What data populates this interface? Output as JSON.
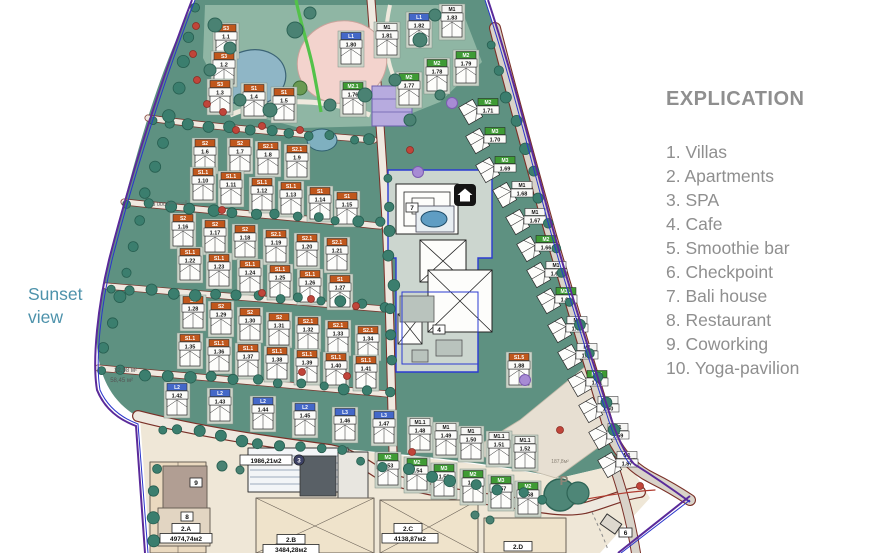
{
  "legend": {
    "title": "EXPLICATION",
    "items": [
      "1. Villas",
      "2. Apartments",
      "3. SPA",
      "4. Cafe",
      "5. Smoothie bar",
      "6. Checkpoint",
      "7. Bali house",
      "8. Restaurant",
      "9. Coworking",
      "10. Yoga-pavilion"
    ]
  },
  "sunset": {
    "line1": "Sunset",
    "line2": "view"
  },
  "map": {
    "colors": {
      "land": "#5e9181",
      "park": "#8fb6a4",
      "beige": "#efe7d7",
      "road": "#efe9e0",
      "road_edge": "#7a3028",
      "boundary_purple": "#5a2a9a",
      "boundary_blue": "#2a35cc",
      "zone": "#ccd6cf",
      "zone_outline": "#2b3bd2",
      "pond": "#8fb6c6",
      "pink": "#f3d3cd",
      "chip_orange": "#c0571c",
      "chip_green": "#3f9b35",
      "chip_blue": "#4468c8",
      "hedge": "#3b7e6e",
      "tree_red": "#c0453a",
      "tree_purple": "#a78bd4"
    },
    "annotations": {
      "dim_3000": "3 000",
      "area_small_1": "32,98 м²",
      "area_small_2": "58,45 м²",
      "parking_area": "187,8м²",
      "parking": "P",
      "spa_area": "1986,21м2",
      "spa_num": "3",
      "b2a": "2.A",
      "b2a_area": "4974,74м2",
      "b2b": "2.B",
      "b2b_area": "3484,28м2",
      "b2c": "2.C",
      "b2c_area": "4138,87м2",
      "b2d": "2.D",
      "coworking_num": "9",
      "restaurant_num": "8",
      "checkpoint_num": "6",
      "cafe_num": "4",
      "bali_num": "7"
    },
    "units": [
      {
        "c": "S3",
        "n": "1.1",
        "x": 226,
        "y": 28,
        "t": "o"
      },
      {
        "c": "S3",
        "n": "1.2",
        "x": 224,
        "y": 56,
        "t": "o"
      },
      {
        "c": "S3",
        "n": "1.3",
        "x": 220,
        "y": 84,
        "t": "o"
      },
      {
        "c": "S1",
        "n": "1.4",
        "x": 254,
        "y": 88,
        "t": "o"
      },
      {
        "c": "S1",
        "n": "1.5",
        "x": 284,
        "y": 92,
        "t": "o"
      },
      {
        "c": "S2",
        "n": "1.6",
        "x": 205,
        "y": 143,
        "t": "o"
      },
      {
        "c": "S2",
        "n": "1.7",
        "x": 240,
        "y": 143,
        "t": "o"
      },
      {
        "c": "S2.1",
        "n": "1.8",
        "x": 268,
        "y": 146,
        "t": "o"
      },
      {
        "c": "S2.1",
        "n": "1.9",
        "x": 297,
        "y": 149,
        "t": "o"
      },
      {
        "c": "S1.1",
        "n": "1.10",
        "x": 203,
        "y": 172,
        "t": "o"
      },
      {
        "c": "S1.1",
        "n": "1.11",
        "x": 231,
        "y": 176,
        "t": "o"
      },
      {
        "c": "S1.1",
        "n": "1.12",
        "x": 262,
        "y": 182,
        "t": "o"
      },
      {
        "c": "S1.1",
        "n": "1.13",
        "x": 291,
        "y": 186,
        "t": "o"
      },
      {
        "c": "S1",
        "n": "1.14",
        "x": 320,
        "y": 191,
        "t": "o"
      },
      {
        "c": "S1",
        "n": "1.15",
        "x": 347,
        "y": 196,
        "t": "o"
      },
      {
        "c": "S2",
        "n": "1.16",
        "x": 183,
        "y": 218,
        "t": "o"
      },
      {
        "c": "S2",
        "n": "1.17",
        "x": 215,
        "y": 224,
        "t": "o"
      },
      {
        "c": "S2",
        "n": "1.18",
        "x": 245,
        "y": 229,
        "t": "o"
      },
      {
        "c": "S2.1",
        "n": "1.19",
        "x": 276,
        "y": 234,
        "t": "o"
      },
      {
        "c": "S2.1",
        "n": "1.20",
        "x": 307,
        "y": 238,
        "t": "o"
      },
      {
        "c": "S2.1",
        "n": "1.21",
        "x": 337,
        "y": 242,
        "t": "o"
      },
      {
        "c": "S1.1",
        "n": "1.22",
        "x": 190,
        "y": 252,
        "t": "o"
      },
      {
        "c": "S1.1",
        "n": "1.23",
        "x": 219,
        "y": 258,
        "t": "o"
      },
      {
        "c": "S1.1",
        "n": "1.24",
        "x": 250,
        "y": 264,
        "t": "o"
      },
      {
        "c": "S1.1",
        "n": "1.25",
        "x": 280,
        "y": 269,
        "t": "o"
      },
      {
        "c": "S1.1",
        "n": "1.26",
        "x": 310,
        "y": 274,
        "t": "o"
      },
      {
        "c": "S1",
        "n": "1.27",
        "x": 340,
        "y": 279,
        "t": "o"
      },
      {
        "c": "S2",
        "n": "1.28",
        "x": 193,
        "y": 300,
        "t": "o"
      },
      {
        "c": "S2",
        "n": "1.29",
        "x": 221,
        "y": 306,
        "t": "o"
      },
      {
        "c": "S2",
        "n": "1.30",
        "x": 250,
        "y": 312,
        "t": "o"
      },
      {
        "c": "S2",
        "n": "1.31",
        "x": 279,
        "y": 317,
        "t": "o"
      },
      {
        "c": "S2.1",
        "n": "1.32",
        "x": 308,
        "y": 321,
        "t": "o"
      },
      {
        "c": "S2.1",
        "n": "1.33",
        "x": 338,
        "y": 325,
        "t": "o"
      },
      {
        "c": "S2.1",
        "n": "1.34",
        "x": 368,
        "y": 330,
        "t": "o"
      },
      {
        "c": "S1.1",
        "n": "1.35",
        "x": 190,
        "y": 338,
        "t": "o"
      },
      {
        "c": "S1.1",
        "n": "1.36",
        "x": 219,
        "y": 343,
        "t": "o"
      },
      {
        "c": "S1.1",
        "n": "1.37",
        "x": 248,
        "y": 348,
        "t": "o"
      },
      {
        "c": "S1.1",
        "n": "1.38",
        "x": 277,
        "y": 351,
        "t": "o"
      },
      {
        "c": "S1.1",
        "n": "1.39",
        "x": 307,
        "y": 354,
        "t": "o"
      },
      {
        "c": "S1.1",
        "n": "1.40",
        "x": 336,
        "y": 357,
        "t": "o"
      },
      {
        "c": "S1.1",
        "n": "1.41",
        "x": 366,
        "y": 360,
        "t": "o"
      },
      {
        "c": "L2",
        "n": "1.42",
        "x": 177,
        "y": 387,
        "t": "b"
      },
      {
        "c": "L2",
        "n": "1.43",
        "x": 220,
        "y": 393,
        "t": "b"
      },
      {
        "c": "L2",
        "n": "1.44",
        "x": 263,
        "y": 401,
        "t": "b"
      },
      {
        "c": "L2",
        "n": "1.45",
        "x": 305,
        "y": 407,
        "t": "b"
      },
      {
        "c": "L3",
        "n": "1.46",
        "x": 345,
        "y": 412,
        "t": "b"
      },
      {
        "c": "L3",
        "n": "1.47",
        "x": 384,
        "y": 415,
        "t": "b"
      },
      {
        "c": "M1.1",
        "n": "1.48",
        "x": 420,
        "y": 422,
        "t": "w"
      },
      {
        "c": "M1",
        "n": "1.49",
        "x": 446,
        "y": 427,
        "t": "w"
      },
      {
        "c": "M1",
        "n": "1.50",
        "x": 471,
        "y": 431,
        "t": "w"
      },
      {
        "c": "M1.1",
        "n": "1.51",
        "x": 499,
        "y": 436,
        "t": "w"
      },
      {
        "c": "M1.1",
        "n": "1.52",
        "x": 525,
        "y": 440,
        "t": "w"
      },
      {
        "c": "M2",
        "n": "1.53",
        "x": 388,
        "y": 457,
        "t": "g"
      },
      {
        "c": "M2",
        "n": "1.54",
        "x": 417,
        "y": 462,
        "t": "g"
      },
      {
        "c": "M3",
        "n": "1.55",
        "x": 444,
        "y": 468,
        "t": "g"
      },
      {
        "c": "M2",
        "n": "1.56",
        "x": 473,
        "y": 474,
        "t": "g"
      },
      {
        "c": "M3",
        "n": "1.57",
        "x": 501,
        "y": 480,
        "t": "g"
      },
      {
        "c": "M2",
        "n": "1.58",
        "x": 528,
        "y": 486,
        "t": "g"
      },
      {
        "c": "L1",
        "n": "1.80",
        "x": 351,
        "y": 36,
        "t": "b"
      },
      {
        "c": "M1",
        "n": "1.81",
        "x": 387,
        "y": 27,
        "t": "w"
      },
      {
        "c": "L1",
        "n": "1.82",
        "x": 419,
        "y": 17,
        "t": "b"
      },
      {
        "c": "M1",
        "n": "1.83",
        "x": 452,
        "y": 9,
        "t": "w"
      },
      {
        "c": "M2.1",
        "n": "1.76",
        "x": 353,
        "y": 86,
        "t": "g"
      },
      {
        "c": "M2",
        "n": "1.77",
        "x": 409,
        "y": 77,
        "t": "g"
      },
      {
        "c": "M2",
        "n": "1.78",
        "x": 437,
        "y": 63,
        "t": "g"
      },
      {
        "c": "M2",
        "n": "1.79",
        "x": 466,
        "y": 55,
        "t": "g"
      },
      {
        "c": "M2",
        "n": "1.71",
        "x": 488,
        "y": 102,
        "t": "g",
        "r": 60
      },
      {
        "c": "M3",
        "n": "1.70",
        "x": 495,
        "y": 131,
        "t": "g",
        "r": 60
      },
      {
        "c": "M3",
        "n": "1.69",
        "x": 505,
        "y": 160,
        "t": "g",
        "r": 60
      },
      {
        "c": "M1",
        "n": "1.68",
        "x": 522,
        "y": 185,
        "t": "w",
        "r": 60
      },
      {
        "c": "M1",
        "n": "1.67",
        "x": 535,
        "y": 212,
        "t": "w",
        "r": 60
      },
      {
        "c": "M2",
        "n": "1.66",
        "x": 546,
        "y": 239,
        "t": "g",
        "r": 60
      },
      {
        "c": "M1",
        "n": "1.65",
        "x": 556,
        "y": 265,
        "t": "w",
        "r": 60
      },
      {
        "c": "M3.1",
        "n": "1.64",
        "x": 566,
        "y": 291,
        "t": "g",
        "r": 60
      },
      {
        "c": "M1",
        "n": "1.63",
        "x": 577,
        "y": 320,
        "t": "w",
        "r": 60
      },
      {
        "c": "M1",
        "n": "1.62",
        "x": 587,
        "y": 347,
        "t": "w",
        "r": 60
      },
      {
        "c": "M3.1",
        "n": "1.61",
        "x": 597,
        "y": 374,
        "t": "g",
        "r": 60
      },
      {
        "c": "M1",
        "n": "1.60",
        "x": 608,
        "y": 400,
        "t": "w",
        "r": 60
      },
      {
        "c": "M1",
        "n": "1.59",
        "x": 618,
        "y": 427,
        "t": "w",
        "r": 60
      },
      {
        "c": "M1",
        "n": "1.87",
        "x": 627,
        "y": 455,
        "t": "w",
        "r": 60
      },
      {
        "c": "S1.5",
        "n": "1.88",
        "x": 519,
        "y": 357,
        "t": "o"
      }
    ]
  }
}
